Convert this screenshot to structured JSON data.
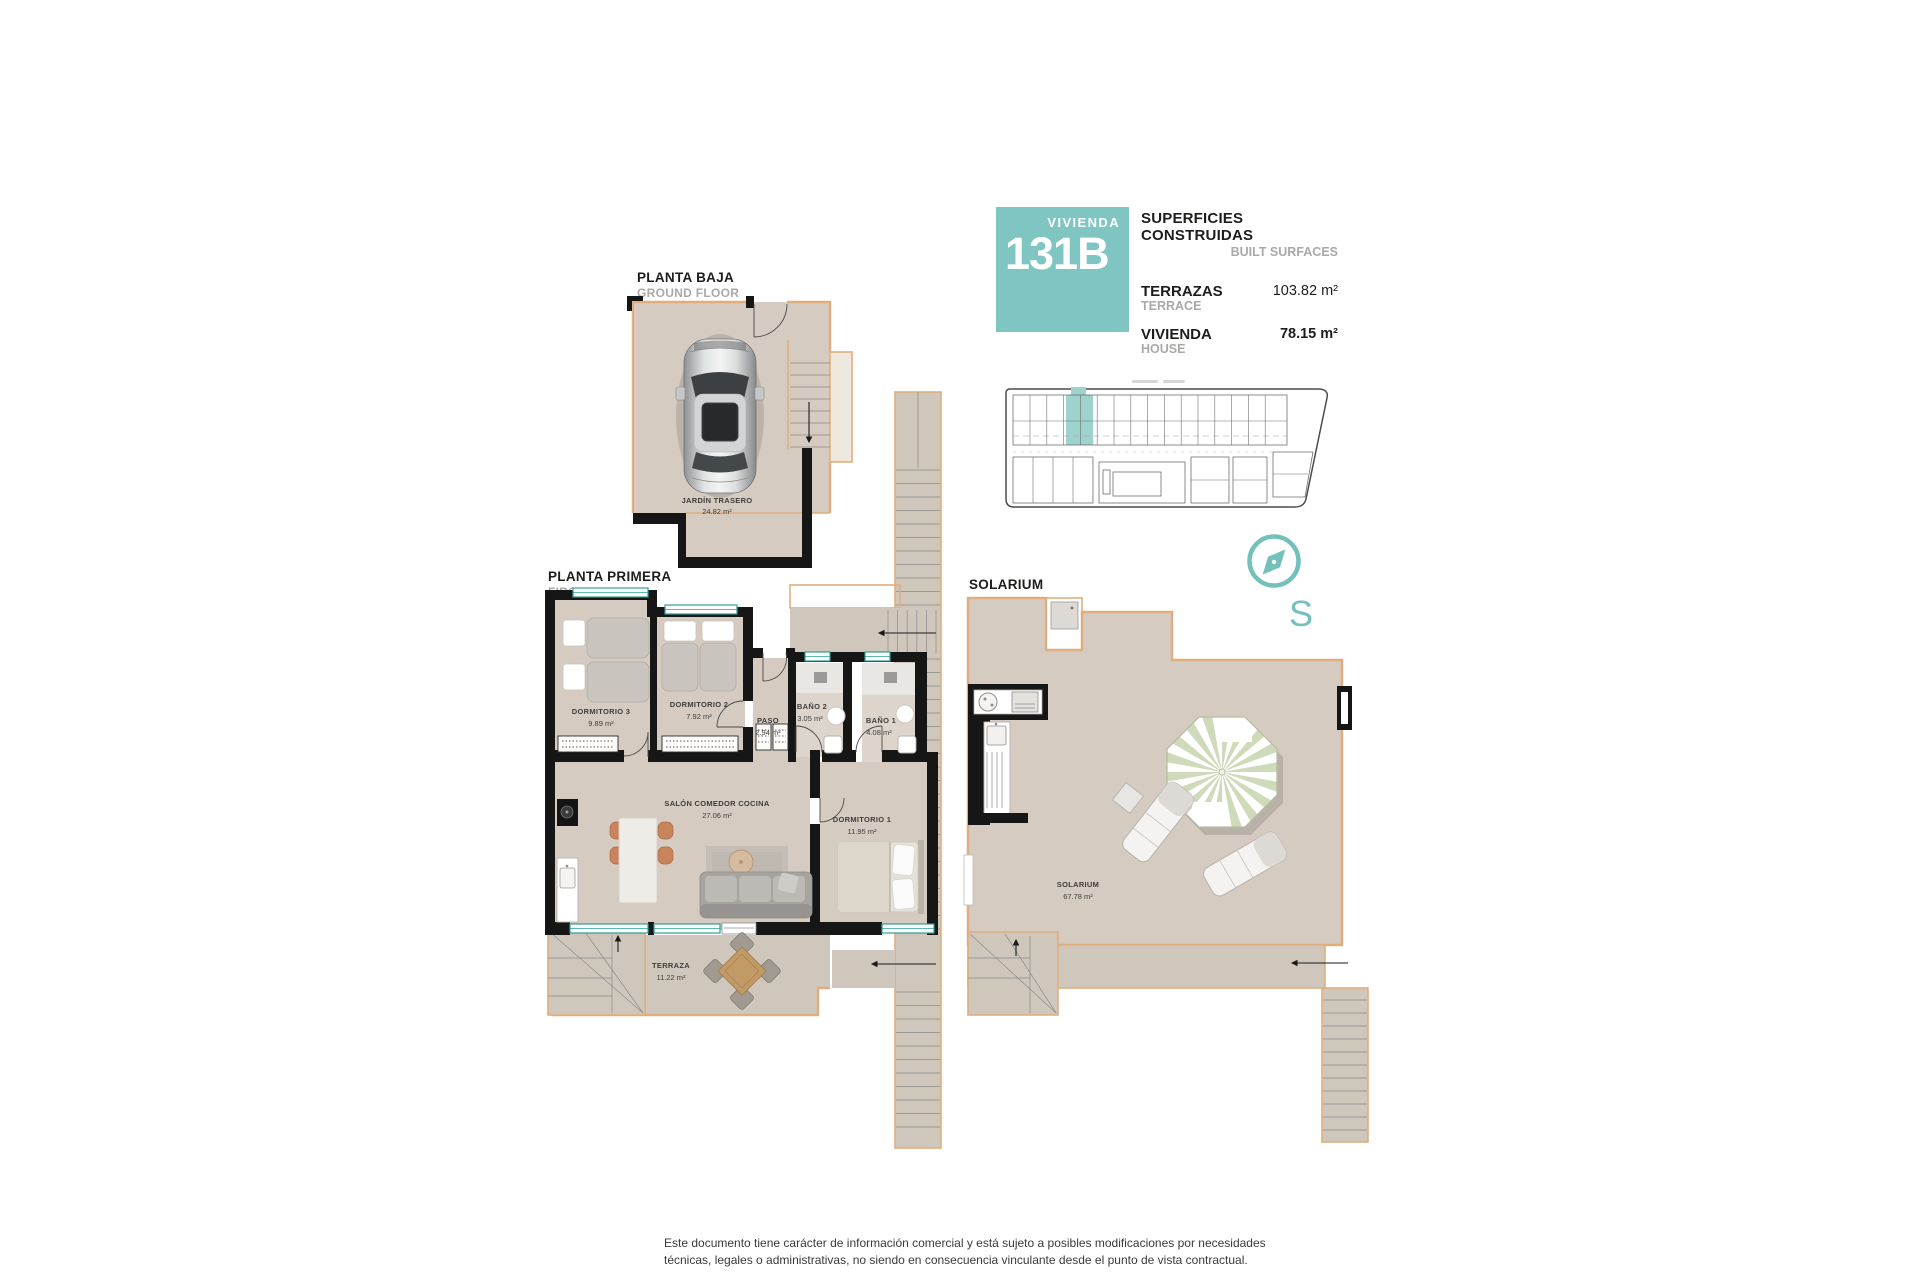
{
  "colors": {
    "accent_teal": "#7fc5c1",
    "floor_beige": "#d5cbc0",
    "wall_tan": "#dfae7f",
    "wall_black": "#161616",
    "window_teal": "#2f9d97",
    "text_dark": "#1d1d1b",
    "text_gray": "#a9a9a8"
  },
  "header": {
    "badge": {
      "label": "VIVIENDA",
      "number": "131B"
    },
    "title_es": "SUPERFICIES CONSTRUIDAS",
    "title_en": "BUILT SURFACES",
    "rows": [
      {
        "label_es": "TERRAZAS",
        "label_en": "TERRACE",
        "value": "103.82 m²"
      },
      {
        "label_es": "VIVIENDA",
        "label_en": "HOUSE",
        "value": "78.15 m²"
      }
    ]
  },
  "plans": {
    "ground": {
      "title_es": "PLANTA BAJA",
      "title_en": "GROUND FLOOR",
      "rooms": [
        {
          "name": "JARDÍN TRASERO",
          "area": "24.82 m²"
        }
      ]
    },
    "first": {
      "title_es": "PLANTA PRIMERA",
      "title_en": "FIRST FLOOR",
      "rooms": [
        {
          "name": "DORMITORIO 3",
          "area": "9.89 m²"
        },
        {
          "name": "DORMITORIO 2",
          "area": "7.92 m²"
        },
        {
          "name": "PASO",
          "area": "2.94 m²"
        },
        {
          "name": "BAÑO 2",
          "area": "3.05 m²"
        },
        {
          "name": "BAÑO 1",
          "area": "4.08 m²"
        },
        {
          "name": "SALÓN COMEDOR COCINA",
          "area": "27.06 m²"
        },
        {
          "name": "DORMITORIO 1",
          "area": "11.95 m²"
        },
        {
          "name": "TERRAZA",
          "area": "11.22 m²"
        }
      ]
    },
    "solarium": {
      "title_es": "SOLARIUM",
      "rooms": [
        {
          "name": "SOLARIUM",
          "area": "67.78 m²"
        }
      ]
    }
  },
  "compass": {
    "south_label": "S"
  },
  "footer": {
    "line1": "Este documento tiene carácter de información comercial y está sujeto a posibles modificaciones por necesidades",
    "line2": "técnicas, legales o administrativas, no siendo en consecuencia vinculante desde el punto de vista contractual."
  }
}
